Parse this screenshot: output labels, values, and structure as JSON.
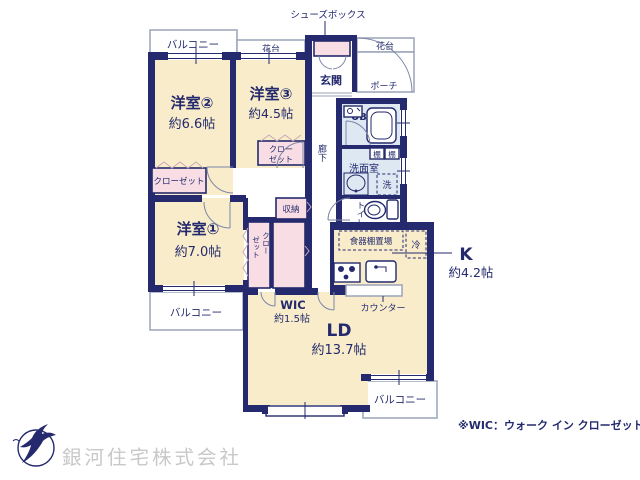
{
  "rooms": {
    "yoshitsu2": {
      "name": "洋室②",
      "size": "約6.6帖"
    },
    "yoshitsu3": {
      "name": "洋室③",
      "size": "約4.5帖"
    },
    "yoshitsu1": {
      "name": "洋室①",
      "size": "約7.0帖"
    },
    "ld": {
      "name": "LD",
      "size": "約13.7帖"
    },
    "kitchen": {
      "name": "K",
      "size": "約4.2帖"
    },
    "wic": {
      "name": "WIC",
      "size": "約1.5帖"
    },
    "genkan": "玄関",
    "porch": "ポーチ",
    "ub": "UB",
    "senmenshitsu": "洗面室",
    "toilet": "トイレ",
    "rouka": "廊下"
  },
  "features": {
    "shoes_box": "シューズボックス",
    "balcony": "バルコニー",
    "hanadai": "花台",
    "closet": "クローゼット",
    "closet_line1": "クロー",
    "closet_line2": "ゼット",
    "shuunou": "収納",
    "tana": "棚",
    "laundry": "洗",
    "fridge": "冷",
    "dish_shelf": "食器棚置場",
    "counter": "カウンター"
  },
  "footer": {
    "note": "※WIC：ウォーク イン クローゼット",
    "company": "銀河住宅株式会社"
  },
  "colors": {
    "wall_navy": "#242a6d",
    "room_cream": "#f8ecca",
    "closet_pink": "#f8dee4",
    "bath_blue": "#dde8f2",
    "outline_gray": "#9aa3b8",
    "company_gray": "#c8c8c8"
  }
}
